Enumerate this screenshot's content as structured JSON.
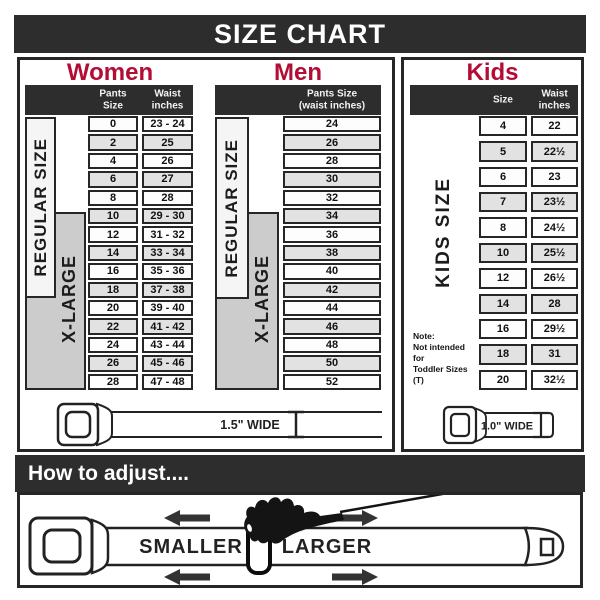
{
  "title": "SIZE CHART",
  "colors": {
    "accent_red": "#b30d36",
    "bar_dark": "#2d2d2d",
    "row_alt": "#e2e2e2",
    "xlarge_box": "#cccccc"
  },
  "women": {
    "heading": "Women",
    "header": {
      "col1": "Pants Size",
      "col2_line1": "Waist",
      "col2_line2": "inches"
    },
    "regular_label": "REGULAR SIZE",
    "xlarge_label": "X-LARGE"
  },
  "men": {
    "heading": "Men",
    "header": {
      "line1": "Pants Size",
      "line2": "(waist inches)"
    },
    "regular_label": "REGULAR SIZE",
    "xlarge_label": "X-LARGE"
  },
  "kids": {
    "heading": "Kids",
    "header": {
      "col1": "Size",
      "col2_line1": "Waist",
      "col2_line2": "inches"
    },
    "side_label": "KIDS SIZE",
    "note_line1": "Note:",
    "note_line2": "Not intended for",
    "note_line3": "Toddler Sizes (T)"
  },
  "belts": {
    "adult_width_label": "1.5\" WIDE",
    "kids_width_label": "1.0\" WIDE"
  },
  "adjust": {
    "heading": "How to adjust....",
    "smaller_label": "SMALLER",
    "larger_label": "LARGER"
  },
  "chart_data": [
    {
      "type": "table",
      "title": "Women",
      "columns": [
        "Pants Size",
        "Waist inches"
      ],
      "rows": [
        [
          "0",
          "23 - 24"
        ],
        [
          "2",
          "25"
        ],
        [
          "4",
          "26"
        ],
        [
          "6",
          "27"
        ],
        [
          "8",
          "28"
        ],
        [
          "10",
          "29 - 30"
        ],
        [
          "12",
          "31 - 32"
        ],
        [
          "14",
          "33 - 34"
        ],
        [
          "16",
          "35 - 36"
        ],
        [
          "18",
          "37 - 38"
        ],
        [
          "20",
          "39 - 40"
        ],
        [
          "22",
          "41 - 42"
        ],
        [
          "24",
          "43 - 44"
        ],
        [
          "26",
          "45 - 46"
        ],
        [
          "28",
          "47 - 48"
        ]
      ],
      "row_groups": [
        {
          "label": "REGULAR SIZE",
          "rows": "0-12"
        },
        {
          "label": "X-LARGE",
          "rows": "10-28"
        }
      ]
    },
    {
      "type": "table",
      "title": "Men",
      "columns": [
        "Pants Size (waist inches)"
      ],
      "rows": [
        [
          "24"
        ],
        [
          "26"
        ],
        [
          "28"
        ],
        [
          "30"
        ],
        [
          "32"
        ],
        [
          "34"
        ],
        [
          "36"
        ],
        [
          "38"
        ],
        [
          "40"
        ],
        [
          "42"
        ],
        [
          "44"
        ],
        [
          "46"
        ],
        [
          "48"
        ],
        [
          "50"
        ],
        [
          "52"
        ]
      ],
      "row_groups": [
        {
          "label": "REGULAR SIZE",
          "rows": "24-32"
        },
        {
          "label": "X-LARGE",
          "rows": "34-52"
        }
      ]
    },
    {
      "type": "table",
      "title": "Kids",
      "columns": [
        "Size",
        "Waist inches"
      ],
      "rows": [
        [
          "4",
          "22"
        ],
        [
          "5",
          "22½"
        ],
        [
          "6",
          "23"
        ],
        [
          "7",
          "23½"
        ],
        [
          "8",
          "24½"
        ],
        [
          "10",
          "25½"
        ],
        [
          "12",
          "26½"
        ],
        [
          "14",
          "28"
        ],
        [
          "16",
          "29½"
        ],
        [
          "18",
          "31"
        ],
        [
          "20",
          "32½"
        ]
      ]
    }
  ]
}
